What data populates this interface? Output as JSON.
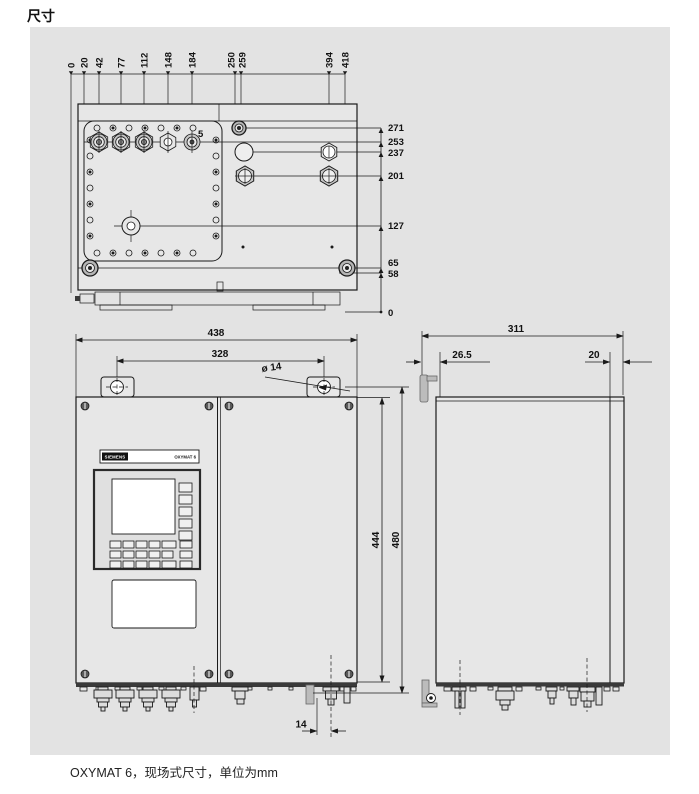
{
  "page": {
    "title": "尺寸",
    "caption": "OXYMAT 6，现场式尺寸，单位为mm"
  },
  "device": {
    "brand": "SIEMENS",
    "model": "OXYMAT 6"
  },
  "top_view": {
    "h_dims": [
      "0",
      "20",
      "42",
      "77",
      "112",
      "148",
      "184",
      "250",
      "259",
      "394",
      "418"
    ],
    "v_dims": [
      "271",
      "253",
      "237",
      "201",
      "127",
      "65",
      "58",
      "0"
    ],
    "gland_note": "5"
  },
  "front_view": {
    "overall_width": "438",
    "hole_spacing": "328",
    "hole_dia": "ø 14",
    "inner_height": "444",
    "overall_height": "480",
    "gland_offset": "14"
  },
  "side_view": {
    "depth": "311",
    "front_gap": "26.5",
    "rear_gap": "20"
  }
}
